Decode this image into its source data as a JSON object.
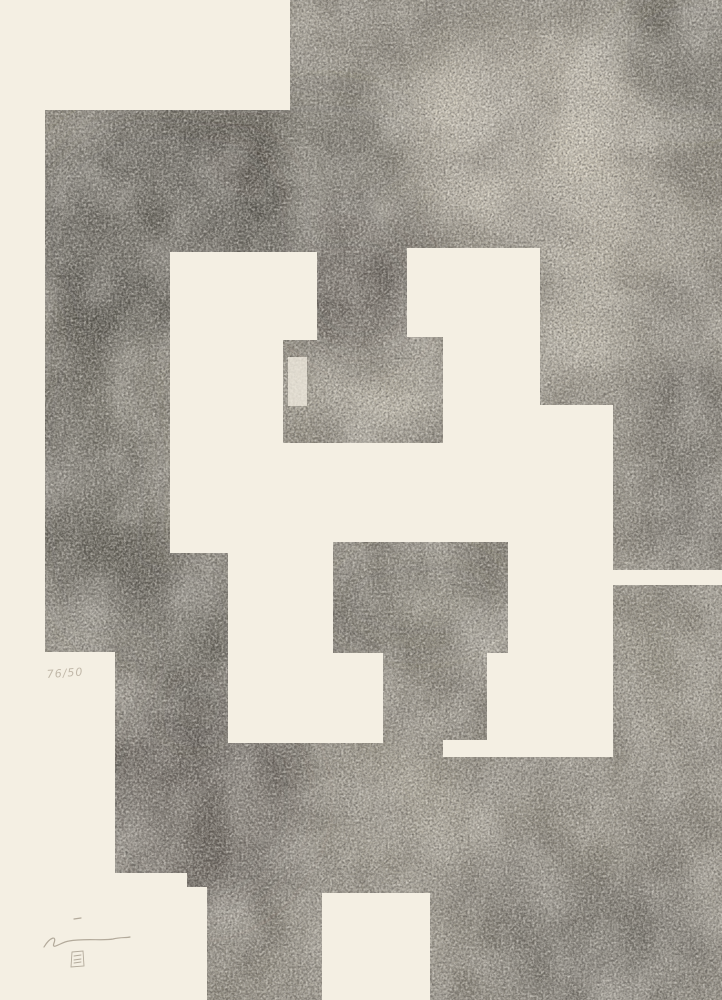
{
  "artwork": {
    "kind": "abstract-print",
    "inscriptions": {
      "edition_mark": "76/50"
    },
    "palette": {
      "paper": "#f4efe3",
      "ink_base": "#8d887b",
      "ink_dark": "#2f2d29",
      "ink_light": "#d9d2c0",
      "pencil": "#a79e8f"
    }
  }
}
